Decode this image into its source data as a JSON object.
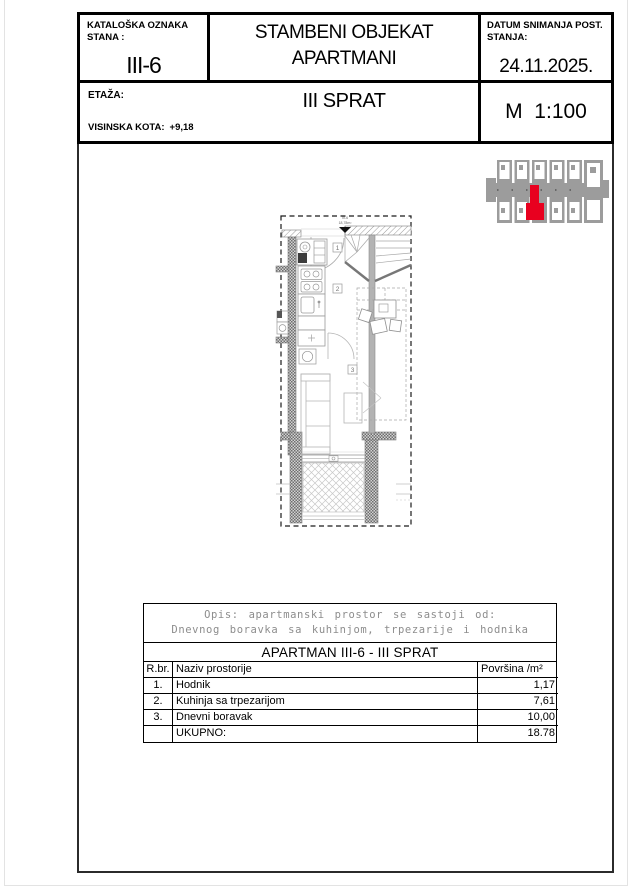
{
  "colors": {
    "highlight_red": "#e8001f",
    "plan_gray": "#9c9c9c"
  },
  "title_block": {
    "catalog_label_1": "KATALOŠKA OZNAKA",
    "catalog_label_2": "STANA :",
    "catalog_value": "III-6",
    "project_title_1": "STAMBENI OBJEKAT",
    "project_title_2": "APARTMANI",
    "date_label_1": "DATUM SNIMANJA POST.",
    "date_label_2": "STANJA:",
    "date_value": "24.11.2025.",
    "floor_label": "ETAŽA:",
    "floor_value": "III SPRAT",
    "elevation_label": "VISINSKA KOTA:",
    "elevation_value": "+9,18",
    "scale_value": "M  1:100"
  },
  "floor_plan": {
    "room_markers": {
      "hallway": "1",
      "kitchen": "2",
      "living": "3"
    },
    "entrance_label_1": "III-6",
    "entrance_label_2": "18,78m²"
  },
  "area_table": {
    "description_1": "Opis: apartmanski prostor se sastoji od:",
    "description_2": "Dnevnog boravka sa kuhinjom, trpezarije i hodnika",
    "title": "APARTMAN III-6 - III SPRAT",
    "col_num": "R.br.",
    "col_name": "Naziv prostorije",
    "col_area": "Površina /m²",
    "rows": [
      {
        "num": "1.",
        "name": "Hodnik",
        "area": "1,17"
      },
      {
        "num": "2.",
        "name": "Kuhinja sa trpezarijom",
        "area": "7,61"
      },
      {
        "num": "3.",
        "name": "Dnevni boravak",
        "area": "10,00"
      },
      {
        "num": "",
        "name": "UKUPNO:",
        "area": "18.78"
      }
    ]
  }
}
